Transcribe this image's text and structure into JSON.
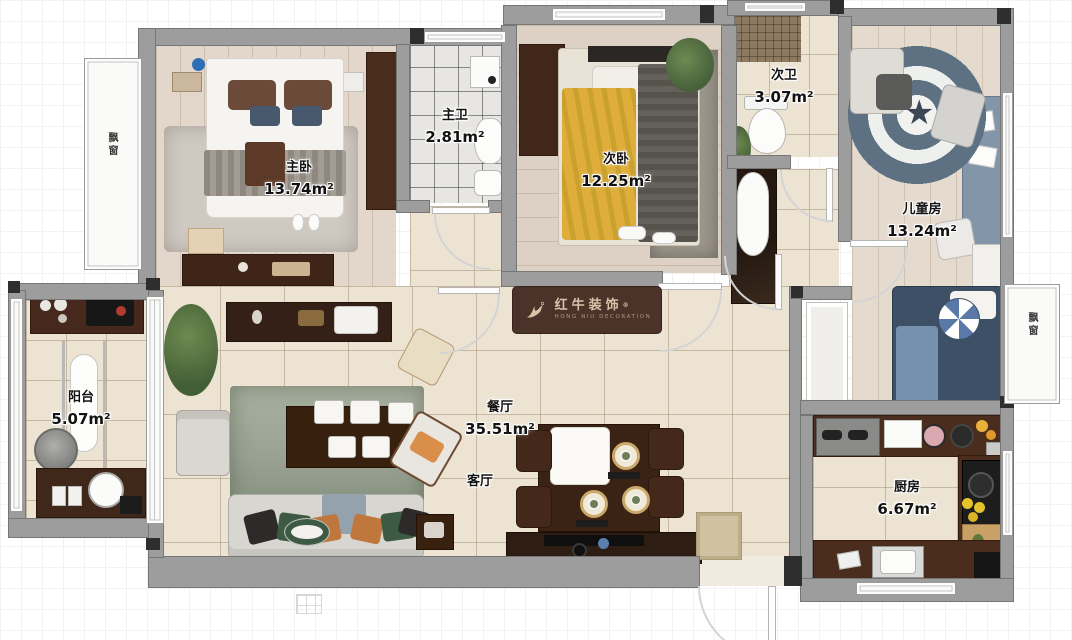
{
  "rooms": [
    {
      "id": "master-bedroom",
      "name": "主卧",
      "area": "13.74m²"
    },
    {
      "id": "master-bath",
      "name": "主卫",
      "area": "2.81m²"
    },
    {
      "id": "second-bedroom",
      "name": "次卧",
      "area": "12.25m²"
    },
    {
      "id": "second-bath",
      "name": "次卫",
      "area": "3.07m²"
    },
    {
      "id": "kids-room",
      "name": "儿童房",
      "area": "13.24m²"
    },
    {
      "id": "balcony",
      "name": "阳台",
      "area": "5.07m²"
    },
    {
      "id": "dining-room",
      "name": "餐厅",
      "area": "35.51m²"
    },
    {
      "id": "living-room",
      "name": "客厅",
      "area": ""
    },
    {
      "id": "kitchen",
      "name": "厨房",
      "area": "6.67m²"
    }
  ],
  "bay_windows": {
    "left": "飘窗",
    "right": "飘窗"
  },
  "logo": {
    "brand": "红牛装饰",
    "brand_en": "HONG NIU DECORATION",
    "registered": "®"
  },
  "icons": {
    "star": "★"
  },
  "colors": {
    "wall": "#9d9d9d",
    "tile_floor": "#ece3d2",
    "wood_floor": "#e2d7ca",
    "cabinet_brown": "#46291c",
    "shield_blue": "#5d7183",
    "bed_yellow": "#dfae3a",
    "kids_bed_navy": "#3e5066"
  }
}
